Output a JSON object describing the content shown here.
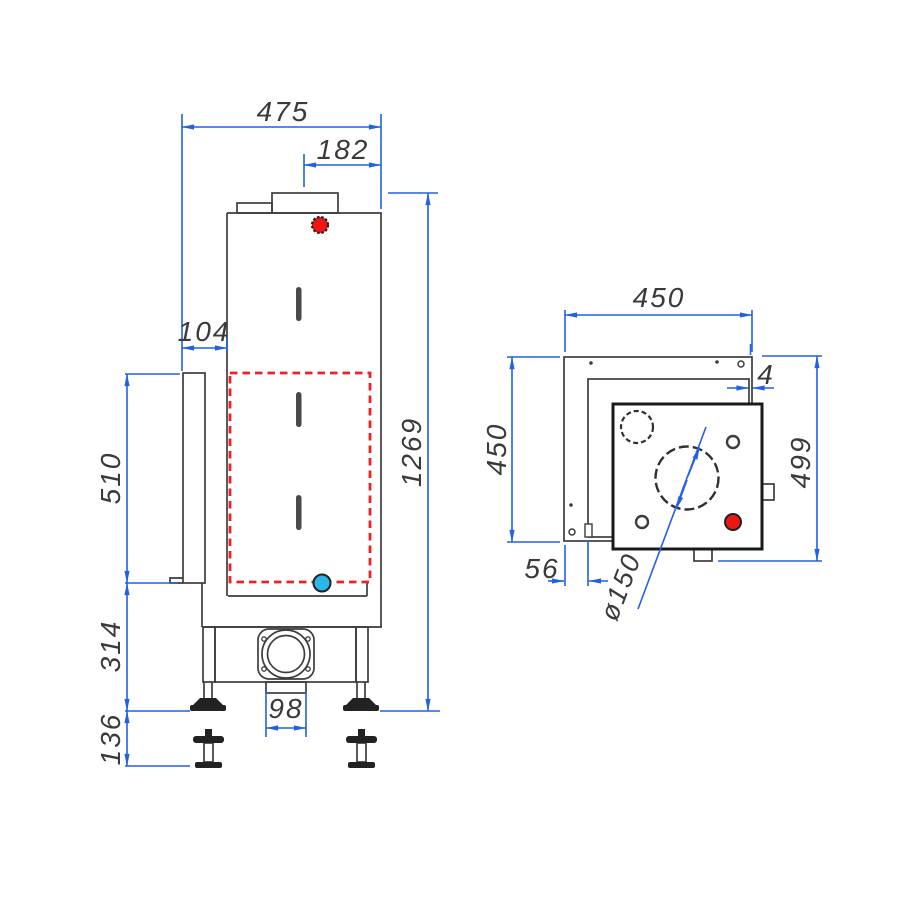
{
  "front_view": {
    "dims": {
      "total_width": "475",
      "flue_center_to_back": "182",
      "front_frame_depth": "104",
      "door_section_height": "510",
      "base_section_height": "314",
      "feet_adjust_height": "136",
      "total_height": "1269",
      "bottom_duct_width": "98"
    }
  },
  "top_view": {
    "dims": {
      "frame_width": "450",
      "frame_depth": "450",
      "rear_gap": "4",
      "total_depth": "499",
      "front_offset": "56",
      "flue_diameter": "ø150"
    }
  },
  "colors": {
    "dimension_blue": "#2261e3",
    "line_dark": "#3d3d3d",
    "accent_red": "#ee1515",
    "accent_cyan": "#29b8e8",
    "dashed_red": "#ee2222"
  }
}
